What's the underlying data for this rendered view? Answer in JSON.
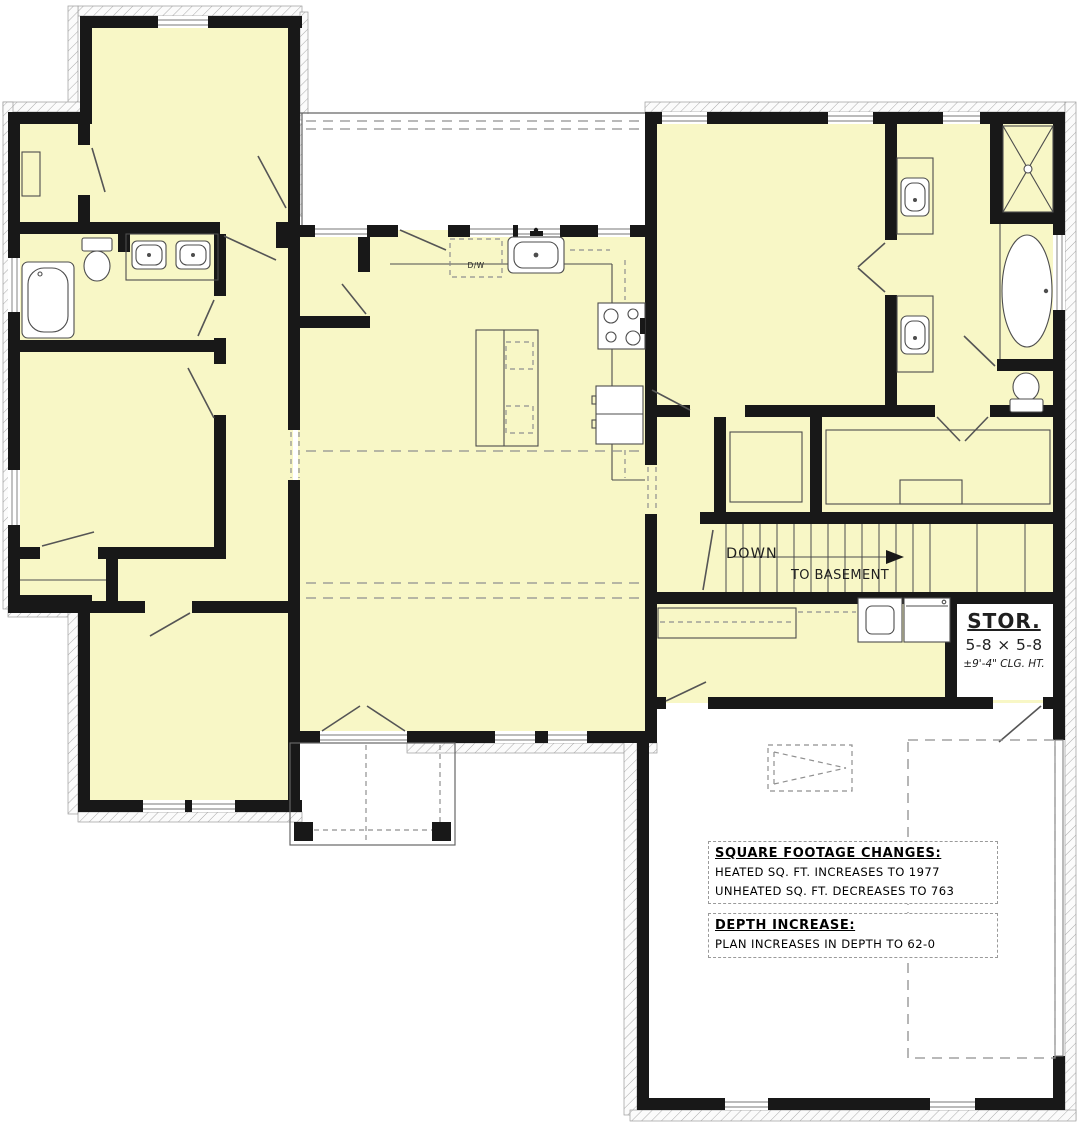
{
  "labels": {
    "dishwasher": "D/W",
    "stairs_down": "DOWN",
    "stairs_to_basement": "TO BASEMENT",
    "storage_name": "STOR.",
    "storage_dims": "5-8 × 5-8",
    "storage_ceiling": "±9'-4\" CLG. HT."
  },
  "notes": {
    "sqft_title": "SQUARE FOOTAGE CHANGES:",
    "sqft_heated": "HEATED SQ. FT. INCREASES TO 1977",
    "sqft_unheated": "UNHEATED SQ. FT. DECREASES TO 763",
    "depth_title": "DEPTH INCREASE:",
    "depth_line": "PLAN INCREASES IN DEPTH TO 62-0"
  },
  "colors": {
    "room_fill": "#F8F7C6",
    "wall": "#181818",
    "fixture": "#4d4d4d",
    "dash": "#8f8f8f",
    "hatch": "#a8a8a8",
    "outline": "#666666",
    "text": "#1f1f1f",
    "paper": "#ffffff"
  }
}
